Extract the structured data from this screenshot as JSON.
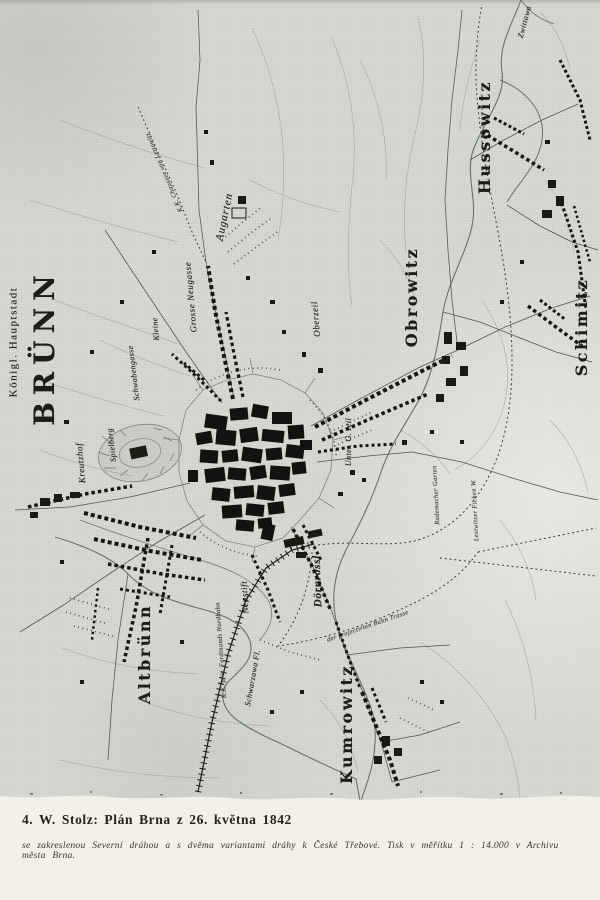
{
  "colors": {
    "paper": "#f3f0e7",
    "scan_background": "#d6d9d2",
    "ink": "#1d1d15"
  },
  "caption": {
    "heading": "4. W. Stolz: Plán Brna z 26. května 1842",
    "subtext": "se zakreslenou Severní dráhou a s dvěma variantami dráhy k České Třebové. Tisk v měřítku 1 : 14.000 v Archivu města Brna."
  },
  "map": {
    "labels": [
      {
        "name": "koenigl-hauptstadt",
        "text": "Königl. Hauptstadt",
        "x": 14,
        "y": 342,
        "rot": -90,
        "cls": "serif-sm"
      },
      {
        "name": "bruenn",
        "text": "BRÜNN",
        "x": 45,
        "y": 347,
        "rot": -90,
        "cls": "town-xl"
      },
      {
        "name": "hussowitz",
        "text": "Hussowitz",
        "x": 485,
        "y": 137,
        "rot": -90,
        "cls": "town-lg"
      },
      {
        "name": "obrowitz",
        "text": "Obrowitz",
        "x": 412,
        "y": 297,
        "rot": -90,
        "cls": "town-lg"
      },
      {
        "name": "schimitz",
        "text": "Schimitz",
        "x": 582,
        "y": 327,
        "rot": -90,
        "cls": "town-lg"
      },
      {
        "name": "altbruenn",
        "text": "Altbrünn",
        "x": 145,
        "y": 654,
        "rot": -90,
        "cls": "town-lg"
      },
      {
        "name": "kumrowitz",
        "text": "Kumrowitz",
        "x": 347,
        "y": 724,
        "rot": -90,
        "cls": "town-lg"
      },
      {
        "name": "augarten",
        "text": "Augarten",
        "x": 225,
        "y": 217,
        "rot": -78,
        "cls": "script-md"
      },
      {
        "name": "grosse-neugasse",
        "text": "Grosse Neugasse",
        "x": 191,
        "y": 297,
        "rot": -95,
        "cls": "script-sm"
      },
      {
        "name": "kleine",
        "text": "Kleine",
        "x": 156,
        "y": 329,
        "rot": -95,
        "cls": "script-xs"
      },
      {
        "name": "schwabengasse",
        "text": "Schwabengasse",
        "x": 134,
        "y": 373,
        "rot": -97,
        "cls": "script-xs"
      },
      {
        "name": "oberzeil",
        "text": "Oberzeil",
        "x": 316,
        "y": 319,
        "rot": -95,
        "cls": "script-sm"
      },
      {
        "name": "kreutzhof",
        "text": "Kreutzhof",
        "x": 81,
        "y": 463,
        "rot": -95,
        "cls": "script-sm"
      },
      {
        "name": "spielberg",
        "text": "Spielberg",
        "x": 112,
        "y": 445,
        "rot": -97,
        "cls": "script-xs"
      },
      {
        "name": "neustift",
        "text": "Neustift",
        "x": 245,
        "y": 597,
        "rot": -93,
        "cls": "script-sm"
      },
      {
        "name": "doernroessl",
        "text": "Dörnrössl",
        "x": 318,
        "y": 581,
        "rot": -92,
        "cls": "script-bold"
      },
      {
        "name": "unter-zeil",
        "text": "Unter. G. zeil",
        "x": 349,
        "y": 442,
        "rot": -90,
        "cls": "script-xs"
      },
      {
        "name": "zwittawa",
        "text": "Zwittawa",
        "x": 525,
        "y": 22,
        "rot": -75,
        "cls": "script-xs"
      },
      {
        "name": "chaussee",
        "text": "K.K. Chaussee von Lettowitz",
        "x": 165,
        "y": 172,
        "rot": -113,
        "cls": "script-xxs"
      },
      {
        "name": "nordbahn",
        "text": "K.K. priv. Ferdinands Nordbahn",
        "x": 222,
        "y": 650,
        "rot": -94,
        "cls": "script-xxs"
      },
      {
        "name": "schwarzawa-fl",
        "text": "Schwarzawa Fl.",
        "x": 253,
        "y": 678,
        "rot": -80,
        "cls": "script-xs"
      },
      {
        "name": "bahn-trasse",
        "text": "der projectirten Bahn Trasse",
        "x": 368,
        "y": 627,
        "rot": -19,
        "cls": "script-xxs"
      },
      {
        "name": "garten",
        "text": "Rademacher Garten",
        "x": 437,
        "y": 495,
        "rot": -93,
        "cls": "script-xxs"
      },
      {
        "name": "fichen-wald",
        "text": "Lestwitzer Fichen W.",
        "x": 476,
        "y": 510,
        "rot": -93,
        "cls": "script-xxs"
      }
    ]
  }
}
